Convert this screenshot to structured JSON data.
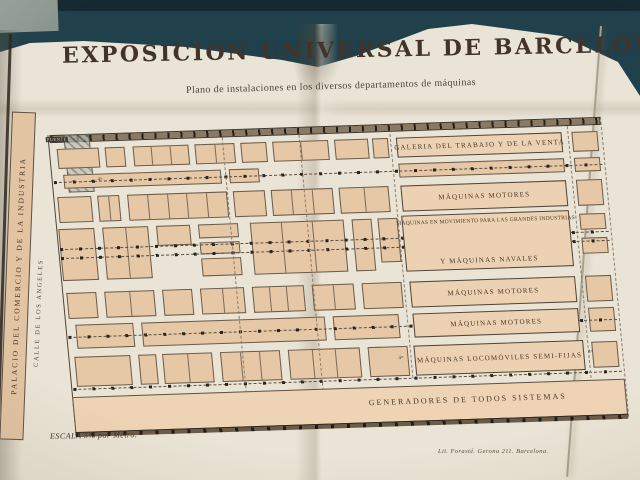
{
  "header": {
    "title": "EXPOSICION UNIVERSAL DE BARCELONA",
    "subtitle": "Plano de instalaciones en los diversos departamentos de máquinas"
  },
  "margin_labels": {
    "palacio": "PALACIO DEL COMERCIO Y DE LA INDUSTRIA",
    "calle": "CALLE DE LOS ANGELES",
    "puente": "PUENTE"
  },
  "bands": {
    "galeria": "GALERIA DEL TRABAJO Y DE LA VENTA",
    "motores1": "MÁQUINAS MOTORES",
    "movimiento_line1": "MÁQUINAS EN MOVIMIENTO PARA LAS GRANDES INDUSTRIAS",
    "movimiento_line2": "Y MÁQUINAS NAVALES",
    "motores2": "MÁQUINAS MOTORES",
    "motores3": "MÁQUINAS MOTORES",
    "locomoviles": "MÁQUINAS LOCOMÓVILES SEMI-FIJAS",
    "generadores": "GENERADORES DE TODOS SISTEMAS"
  },
  "dims": {
    "d4": "4ᵐ"
  },
  "footer": {
    "scale": "ESCALA 5% por Metro.",
    "imprint": "Lit. Forasté. Gerona 211. Barcelona."
  },
  "colors": {
    "table_teal": "#20404b",
    "paper_cream": "#eae4d6",
    "block_tan": "#e6c8a6",
    "band_tan": "#ecd2b2",
    "ink_brown": "#453729"
  }
}
